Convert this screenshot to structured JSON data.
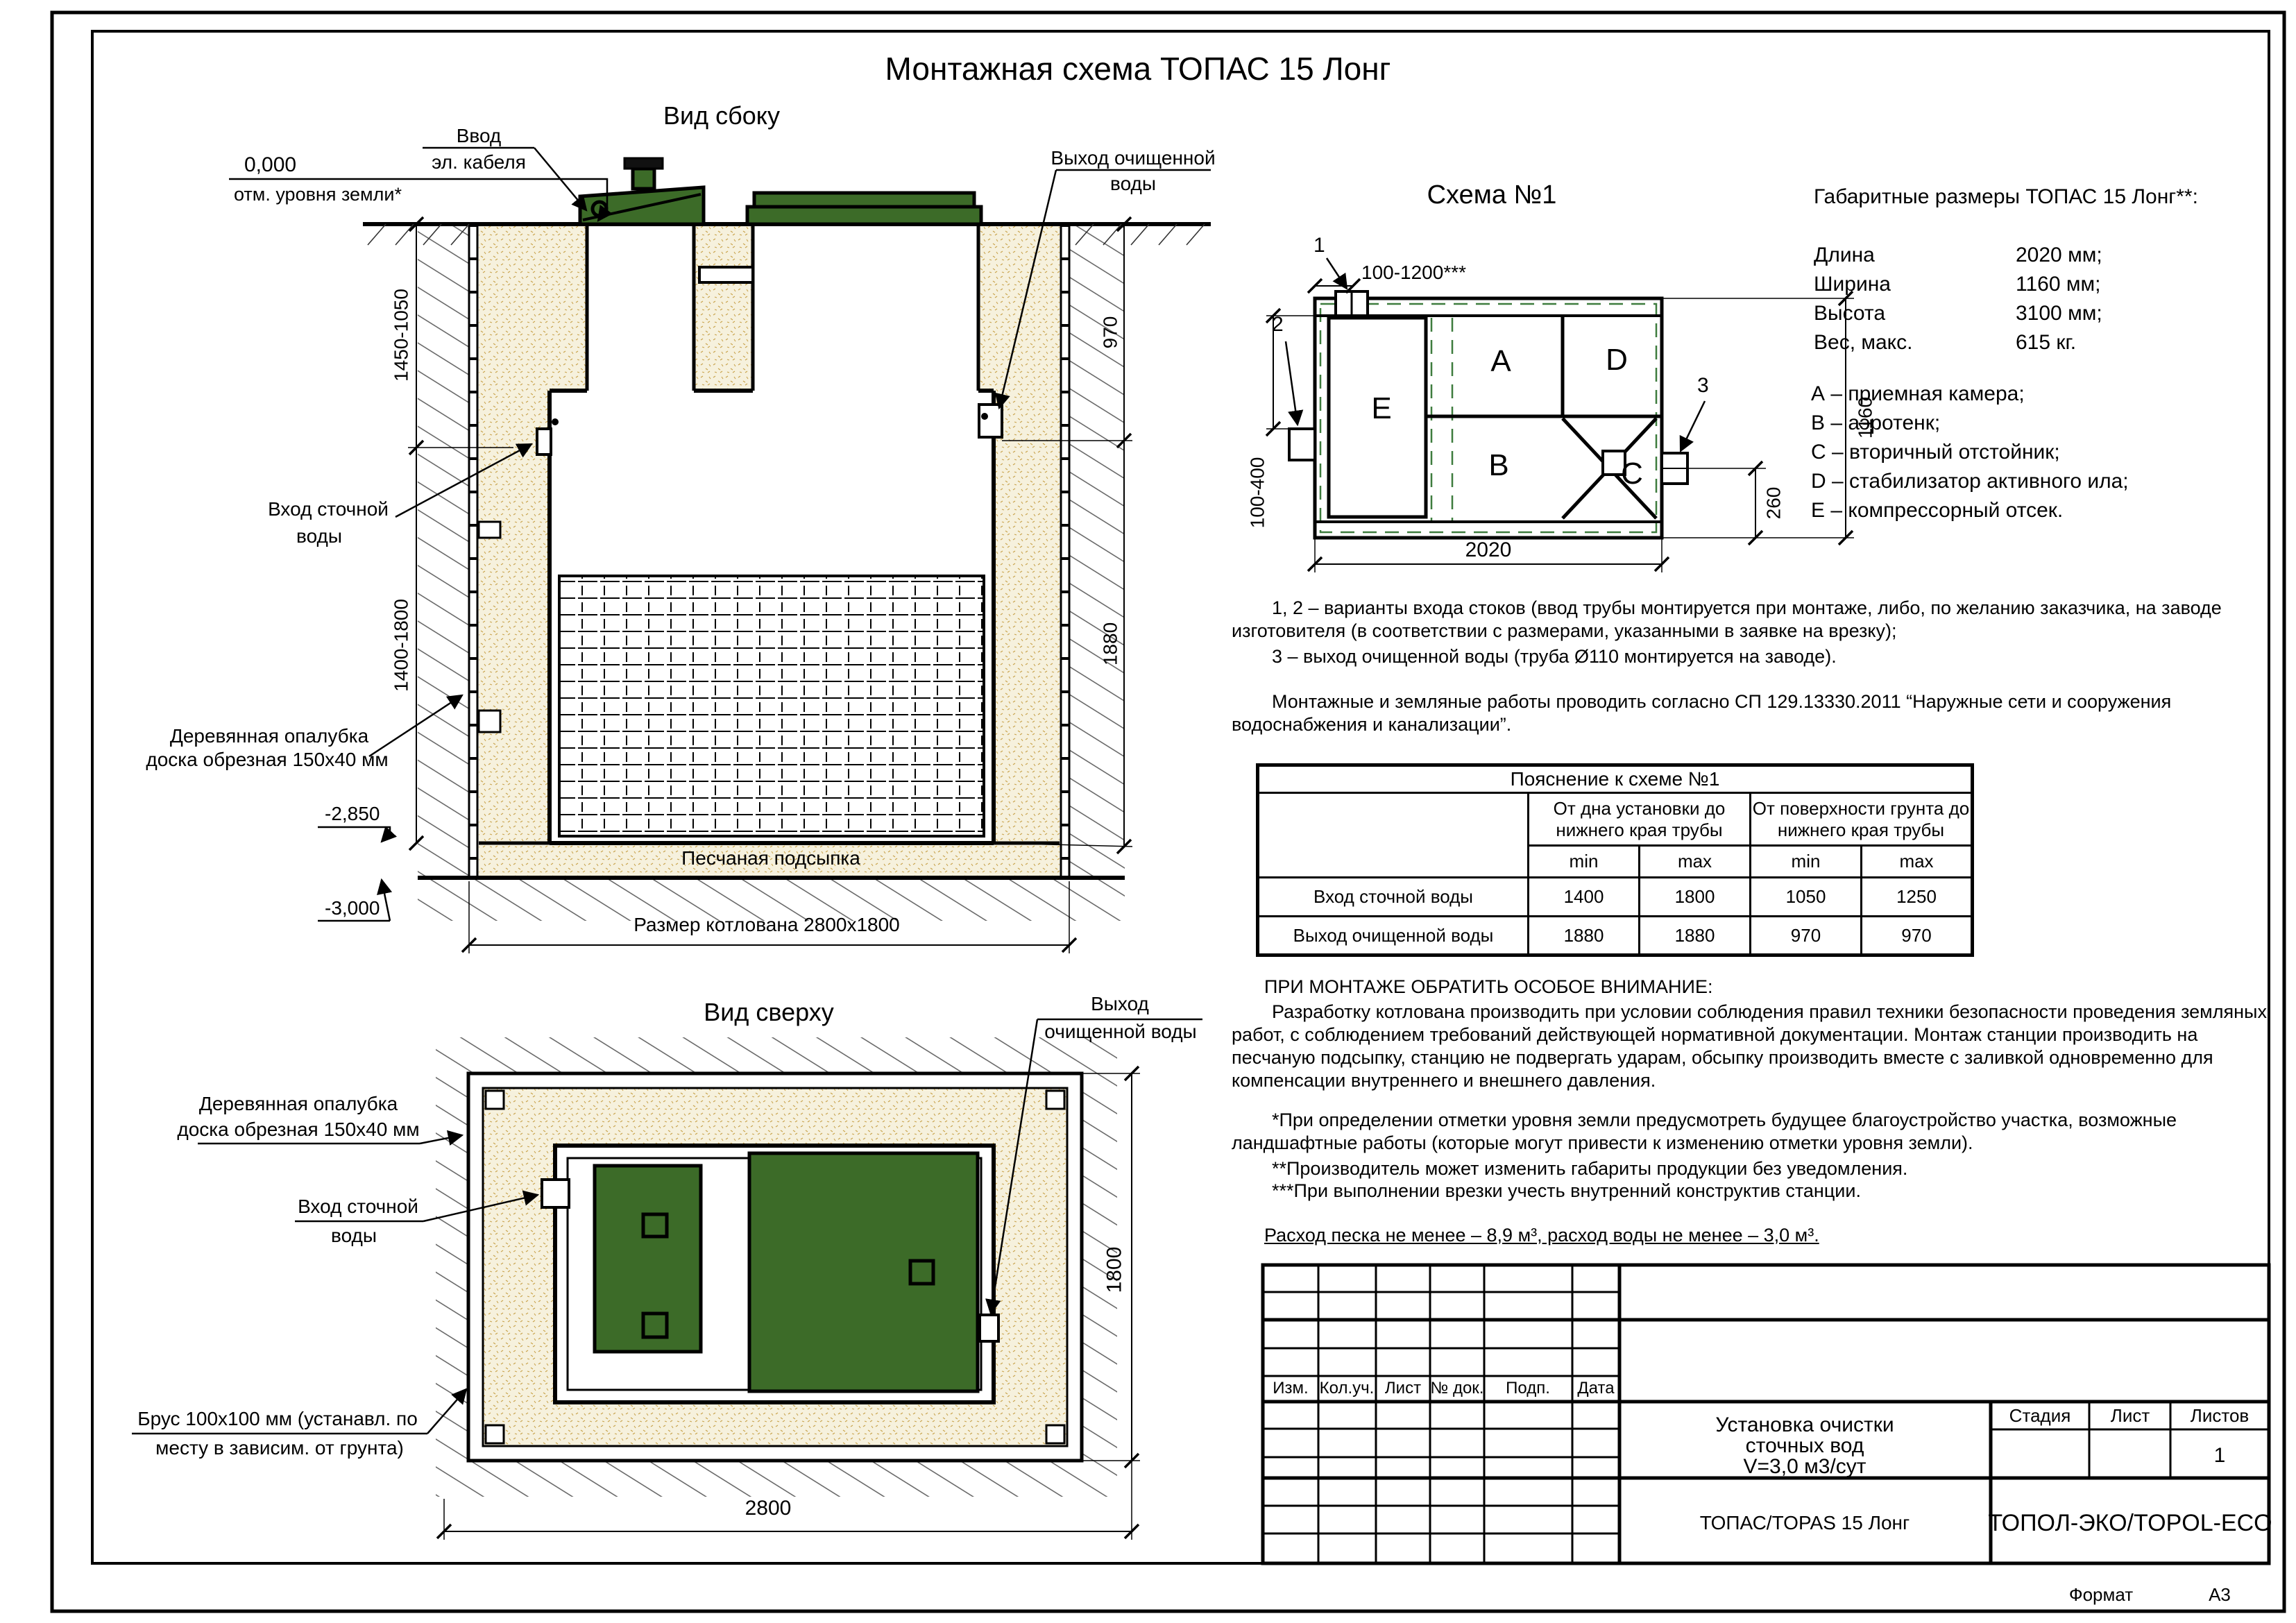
{
  "sheet": {
    "title": "Монтажная схема ТОПАС 15 Лонг",
    "format_label": "Формат",
    "format_value": "А3"
  },
  "side_view": {
    "title": "Вид сбоку",
    "datum": "0,000",
    "datum_note": "отм. уровня земли*",
    "cable_l1": "Ввод",
    "cable_l2": "эл. кабеля",
    "outlet_l1": "Выход очищенной",
    "outlet_l2": "воды",
    "inlet_l1": "Вход сточной",
    "inlet_l2": "воды",
    "formwork_l1": "Деревянная опалубка",
    "formwork_l2": "доска обрезная 150х40 мм",
    "level_base": "-2,850",
    "level_pit": "-3,000",
    "sand": "Песчаная подсыпка",
    "pit": "Размер котлована 2800х1800",
    "dim_left_top": "1450-1050",
    "dim_left_bottom": "1400-1800",
    "dim_right_top": "970",
    "dim_right_bottom": "1880"
  },
  "schema": {
    "title": "Схема №1",
    "m1": "1",
    "m2": "2",
    "m3": "3",
    "dim_top": "100-1200***",
    "dim_left": "100-400",
    "dim_right": "1160",
    "dim_outlet": "260",
    "dim_bottom": "2020",
    "c_a": "A",
    "c_b": "B",
    "c_c": "C",
    "c_d": "D",
    "c_e": "E"
  },
  "dims_block": {
    "title": "Габаритные размеры ТОПАС 15 Лонг**:",
    "rows": [
      {
        "k": "Длина",
        "v": "2020 мм;"
      },
      {
        "k": "Ширина",
        "v": "1160 мм;"
      },
      {
        "k": "Высота",
        "v": "3100 мм;"
      },
      {
        "k": "Вес, макс.",
        "v": "615 кг."
      }
    ],
    "legend": [
      "А – приемная камера;",
      "В – аэротенк;",
      "С – вторичный отстойник;",
      "D – стабилизатор активного ила;",
      "Е – компрессорный отсек."
    ]
  },
  "notes": {
    "p1": "1, 2 – варианты входа  стоков (ввод трубы монтируется при монтаже, либо, по желанию заказчика, на заводе изготовителя (в соответствии с размерами, указанными в заявке на врезку);",
    "p2": "3 – выход очищенной воды (труба Ø110 монтируется на заводе).",
    "p3": "Монтажные и земляные работы проводить согласно СП 129.13330.2011 “Наружные сети и сооружения водоснабжения и канализации”."
  },
  "explain_table": {
    "title": "Пояснение к схеме №1",
    "g1": "От дна установки до нижнего края трубы",
    "g2": "От поверхности грунта до нижнего края трубы",
    "min": "min",
    "max": "max",
    "rows": [
      {
        "name": "Вход сточной воды",
        "c1": "1400",
        "c2": "1800",
        "c3": "1050",
        "c4": "1250"
      },
      {
        "name": "Выход очищенной воды",
        "c1": "1880",
        "c2": "1880",
        "c3": "970",
        "c4": "970"
      }
    ]
  },
  "attention": {
    "title": "ПРИ МОНТАЖЕ ОБРАТИТЬ ОСОБОЕ ВНИМАНИЕ:",
    "p1": "Разработку котлована производить при условии соблюдения правил техники безопасности проведения земляных работ, с соблюдением требований действующей нормативной документации. Монтаж станции производить на песчаную подсыпку, станцию не подвергать ударам, обсыпку производить вместе с заливкой одновременно для компенсации внутреннего и внешнего давления.",
    "fn1": "*При определении отметки уровня земли предусмотреть будущее благоустройство участка, возможные ландшафтные работы (которые могут привести к изменению отметки уровня земли).",
    "fn2": "**Производитель может изменить габариты продукции без уведомления.",
    "fn3": "***При выполнении врезки учесть внутренний конструктив станции.",
    "consumption": "Расход песка не менее – 8,9 м³, расход воды не менее – 3,0 м³."
  },
  "top_view": {
    "title": "Вид сверху",
    "formwork_l1": "Деревянная опалубка",
    "formwork_l2": "доска обрезная 150х40 мм",
    "inlet_l1": "Вход сточной",
    "inlet_l2": "воды",
    "outlet_l1": "Выход",
    "outlet_l2": "очищенной воды",
    "brus_l1": "Брус 100х100 мм (устанавл. по",
    "brus_l2": "месту в зависим. от грунта)",
    "dim_w": "2800",
    "dim_h": "1800"
  },
  "title_block": {
    "rev": [
      "Изм.",
      "Кол.уч.",
      "Лист",
      "№ док.",
      "Подп.",
      "Дата"
    ],
    "doc1": "Установка очистки",
    "doc2": "сточных вод",
    "doc3": "V=3,0 м3/сут",
    "stage": "Стадия",
    "sheet": "Лист",
    "sheets": "Листов",
    "sheets_val": "1",
    "product": "ТОПАС/TOPAS 15 Лонг",
    "company": "ТОПОЛ-ЭКО/TOPOL-ECO"
  }
}
